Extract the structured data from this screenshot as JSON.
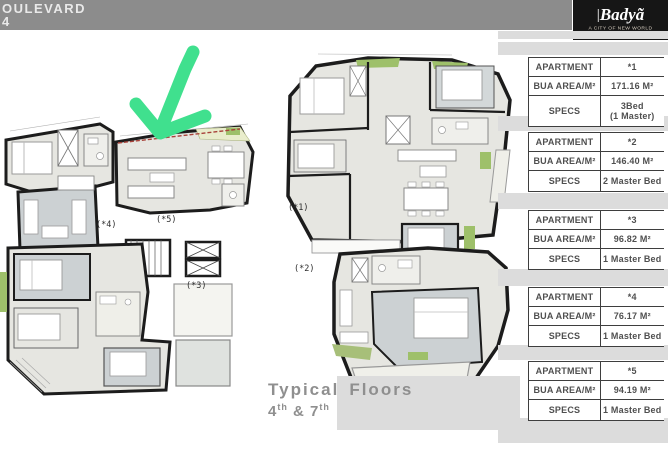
{
  "header": {
    "title_line1": "OULEVARD",
    "title_line2": "4"
  },
  "brand": {
    "separator": "|",
    "name": "Badyã",
    "tagline": "A CITY OF NEW WORLD"
  },
  "table": {
    "labels": {
      "apartment": "APARTMENT",
      "bua": "BUA AREA/M²",
      "specs": "SPECS"
    },
    "blocks": [
      {
        "apartment": "*1",
        "bua": "171.16 M²",
        "specs1": "3Bed",
        "specs2": "(1 Master)"
      },
      {
        "apartment": "*2",
        "bua": "146.40 M²",
        "specs1": "2 Master Bed",
        "specs2": ""
      },
      {
        "apartment": "*3",
        "bua": "96.82 M²",
        "specs1": "1 Master Bed",
        "specs2": ""
      },
      {
        "apartment": "*4",
        "bua": "76.17 M²",
        "specs1": "1 Master Bed",
        "specs2": ""
      },
      {
        "apartment": "*5",
        "bua": "94.19 M²",
        "specs1": "1 Master Bed",
        "specs2": ""
      }
    ]
  },
  "plan": {
    "unit_labels": {
      "u1": "(*1)",
      "u2": "(*2)",
      "u3": "(*3)",
      "u4": "(*4)",
      "u5": "(*5)"
    },
    "caption": {
      "line1_word1": "Typical",
      "line1_word2": "Floors",
      "floor_a": "4",
      "floor_a_sup": "th",
      "joiner": " & ",
      "floor_b": "7",
      "floor_b_sup": "th"
    }
  },
  "colors": {
    "arrow_green": "#40e08e",
    "header_gray": "#8c8c8c",
    "brand_black": "#161616",
    "room_fill": "#e6e6e1",
    "room_dark_fill": "#ccd1d3",
    "landscape_green": "#9ec06a",
    "strip_gray": "#dcdcdc"
  }
}
